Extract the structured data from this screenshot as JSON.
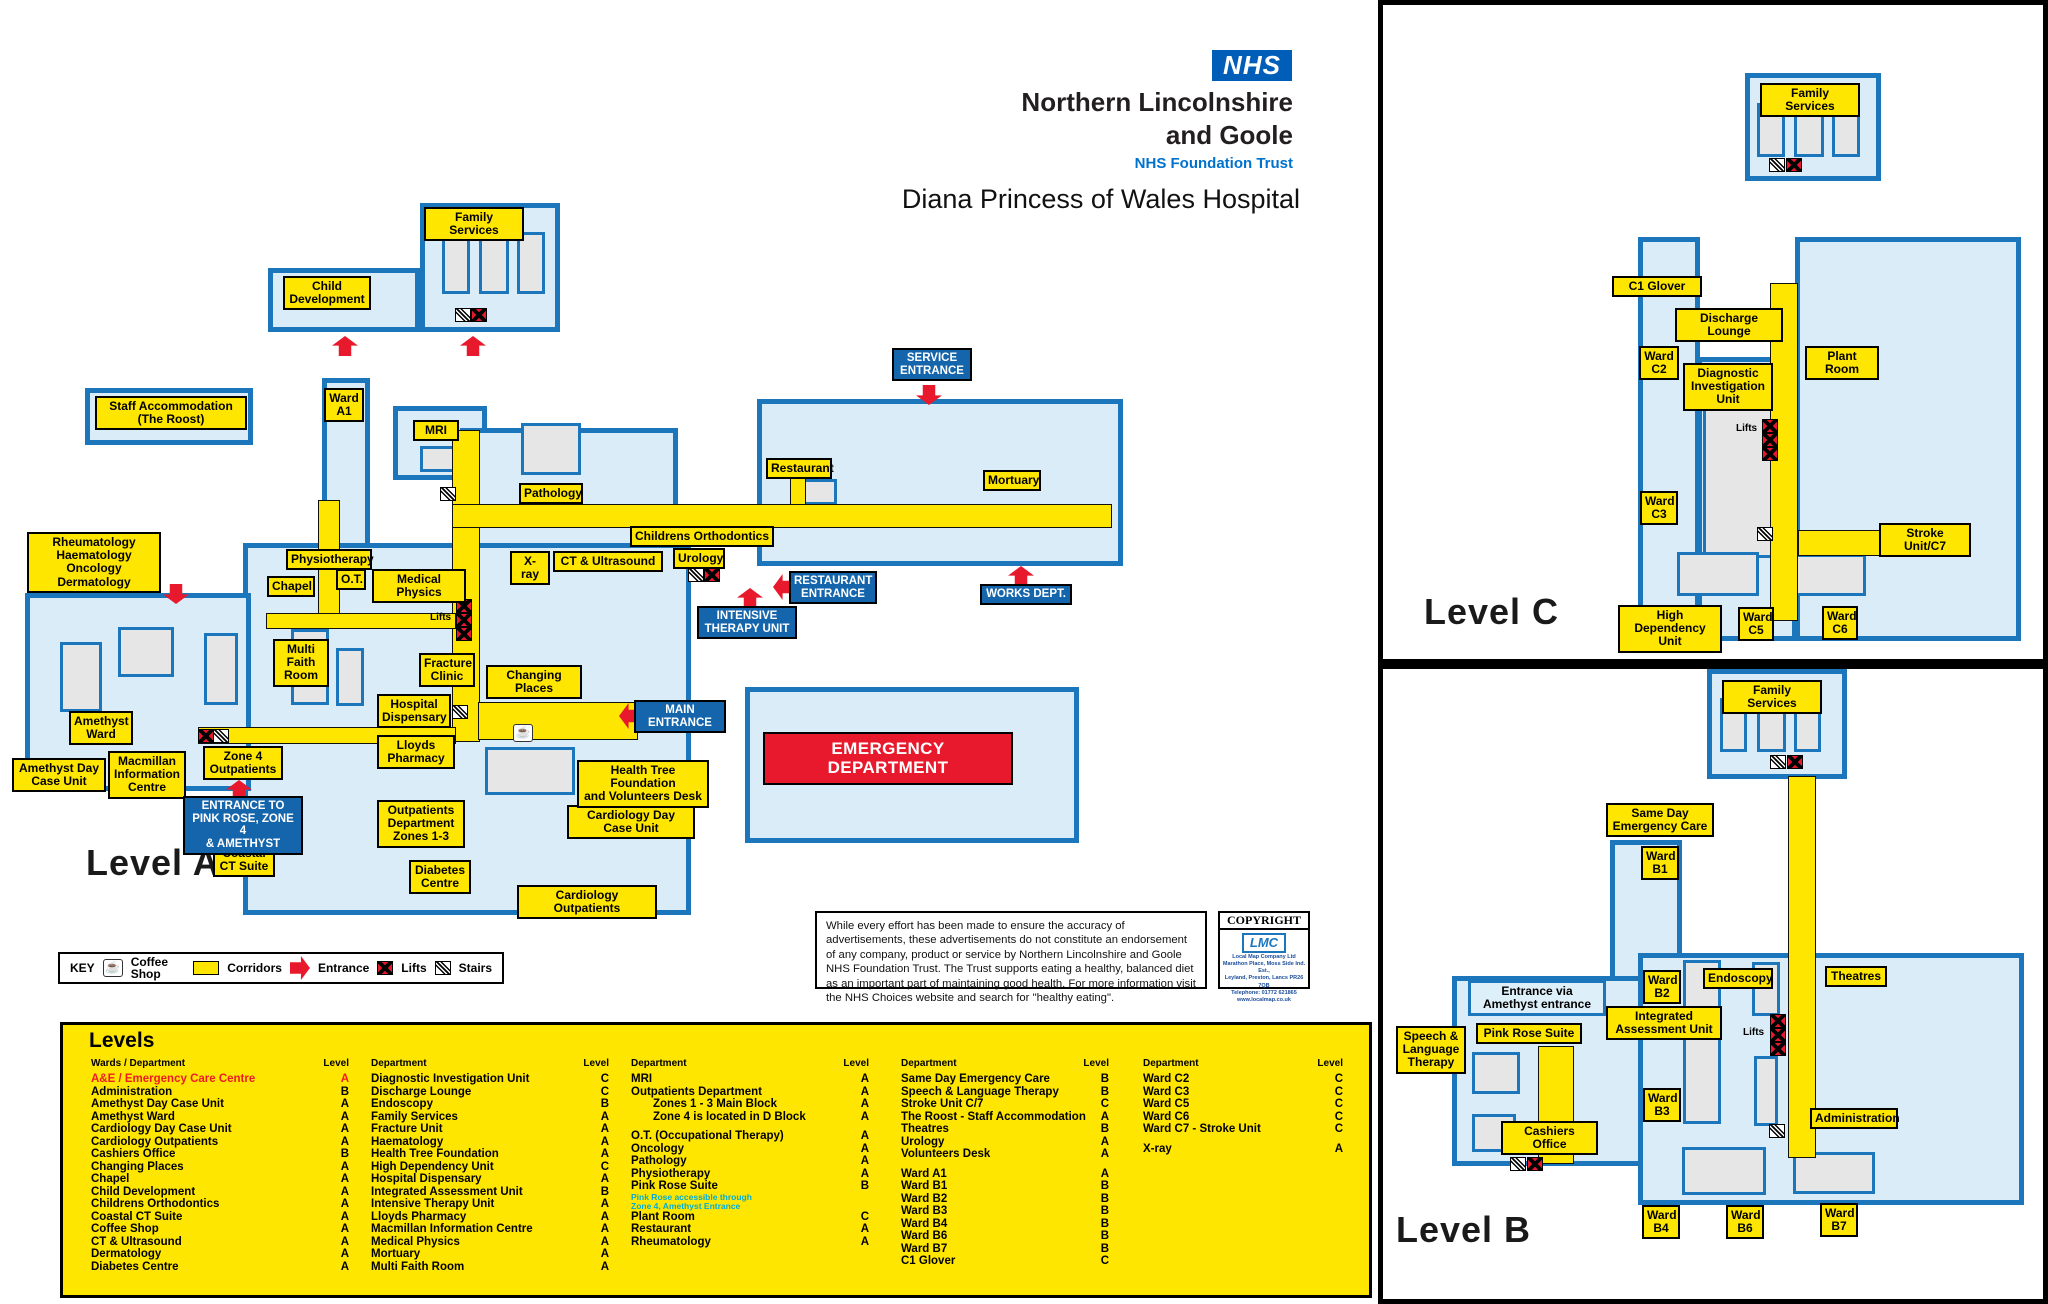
{
  "branding": {
    "nhs_logo": "NHS",
    "trust_line1": "Northern Lincolnshire",
    "trust_line2": "and Goole",
    "trust_sub": "NHS Foundation Trust",
    "hospital": "Diana Princess of Wales Hospital"
  },
  "panels": {
    "level_a_title": "Level A",
    "level_b_title": "Level B",
    "level_c_title": "Level C"
  },
  "key": {
    "title": "KEY",
    "items": [
      {
        "icon": "coffee-shop-icon",
        "label": "Coffee Shop"
      },
      {
        "icon": "corridor-swatch",
        "label": "Corridors"
      },
      {
        "icon": "entrance-arrow-icon",
        "label": "Entrance"
      },
      {
        "icon": "lift-icon",
        "label": "Lifts"
      },
      {
        "icon": "stairs-icon",
        "label": "Stairs"
      }
    ]
  },
  "disclaimer": {
    "text": "While every effort has been made to ensure the accuracy of advertisements, these advertisements do not constitute an endorsement of any company, product or service by Northern Lincolnshire and Goole NHS Foundation Trust. The Trust supports eating a healthy, balanced diet as an important part of maintaining good health. For more information visit the NHS Choices website and search for \"healthy eating\"."
  },
  "copyright": {
    "title": "COPYRIGHT",
    "logo": "LMC",
    "company": "Local Map Company Ltd",
    "address1": "Marathon Place, Moss Side Ind. Est.,",
    "address2": "Leyland, Preston, Lancs PR26 7QB",
    "phone": "Telephone: 01772 621865",
    "website": "www.localmap.co.uk"
  },
  "directory": {
    "title": "Levels",
    "columns": [
      {
        "dept_header": "Wards / Department",
        "level_header": "Level",
        "entries": [
          {
            "d": "A&E / Emergency Care Centre",
            "l": "A",
            "s": "red"
          },
          {
            "d": "Administration",
            "l": "B"
          },
          {
            "d": "Amethyst Day Case Unit",
            "l": "A"
          },
          {
            "d": "Amethyst Ward",
            "l": "A"
          },
          {
            "d": "Cardiology Day Case Unit",
            "l": "A"
          },
          {
            "d": "Cardiology Outpatients",
            "l": "A"
          },
          {
            "d": "Cashiers Office",
            "l": "B"
          },
          {
            "d": "Changing Places",
            "l": "A"
          },
          {
            "d": "Chapel",
            "l": "A"
          },
          {
            "d": "Child Development",
            "l": "A"
          },
          {
            "d": "Childrens Orthodontics",
            "l": "A"
          },
          {
            "d": "Coastal CT Suite",
            "l": "A"
          },
          {
            "d": "Coffee Shop",
            "l": "A"
          },
          {
            "d": "CT & Ultrasound",
            "l": "A"
          },
          {
            "d": "Dermatology",
            "l": "A"
          },
          {
            "d": "Diabetes Centre",
            "l": "A"
          }
        ]
      },
      {
        "dept_header": "Department",
        "level_header": "Level",
        "entries": [
          {
            "d": "Diagnostic Investigation Unit",
            "l": "C"
          },
          {
            "d": "Discharge Lounge",
            "l": "C"
          },
          {
            "d": "Endoscopy",
            "l": "B"
          },
          {
            "d": "Family Services",
            "l": "A"
          },
          {
            "d": "Fracture Unit",
            "l": "A"
          },
          {
            "d": "Haematology",
            "l": "A"
          },
          {
            "d": "Health Tree Foundation",
            "l": "A"
          },
          {
            "d": "High Dependency Unit",
            "l": "C"
          },
          {
            "d": "Hospital Dispensary",
            "l": "A"
          },
          {
            "d": "Integrated Assessment Unit",
            "l": "B"
          },
          {
            "d": "Intensive Therapy Unit",
            "l": "A"
          },
          {
            "d": "Lloyds Pharmacy",
            "l": "A"
          },
          {
            "d": "Macmillan Information Centre",
            "l": "A"
          },
          {
            "d": "Medical Physics",
            "l": "A"
          },
          {
            "d": "Mortuary",
            "l": "A"
          },
          {
            "d": "Multi Faith Room",
            "l": "A"
          }
        ]
      },
      {
        "dept_header": "Department",
        "level_header": "Level",
        "entries": [
          {
            "d": "MRI",
            "l": "A"
          },
          {
            "d": "Outpatients Department",
            "l": "A"
          },
          {
            "d": "Zones 1 - 3 Main Block",
            "l": "A",
            "s": "indent"
          },
          {
            "d": "Zone 4 is located in D Block",
            "l": "A",
            "s": "indent"
          },
          {
            "s": "gap"
          },
          {
            "d": "O.T. (Occupational Therapy)",
            "l": "A"
          },
          {
            "d": "Oncology",
            "l": "A"
          },
          {
            "d": "Pathology",
            "l": "A"
          },
          {
            "d": "Physiotherapy",
            "l": "A"
          },
          {
            "d": "Pink Rose Suite",
            "l": "B"
          },
          {
            "d": "Pink Rose accessible through\nZone 4, Amethyst Entrance",
            "s": "note"
          },
          {
            "d": "Plant Room",
            "l": "C"
          },
          {
            "d": "Restaurant",
            "l": "A"
          },
          {
            "d": "Rheumatology",
            "l": "A"
          }
        ]
      },
      {
        "dept_header": "Department",
        "level_header": "Level",
        "entries": [
          {
            "d": "Same Day Emergency Care",
            "l": "B"
          },
          {
            "d": "Speech & Language Therapy",
            "l": "B"
          },
          {
            "d": "Stroke Unit C/7",
            "l": "C"
          },
          {
            "d": "The Roost - Staff Accommodation",
            "l": "A"
          },
          {
            "d": "Theatres",
            "l": "B"
          },
          {
            "d": "Urology",
            "l": "A"
          },
          {
            "d": "Volunteers Desk",
            "l": "A"
          },
          {
            "s": "gap"
          },
          {
            "d": "Ward A1",
            "l": "A"
          },
          {
            "d": "Ward B1",
            "l": "B"
          },
          {
            "d": "Ward B2",
            "l": "B"
          },
          {
            "d": "Ward B3",
            "l": "B"
          },
          {
            "d": "Ward B4",
            "l": "B"
          },
          {
            "d": "Ward B6",
            "l": "B"
          },
          {
            "d": "Ward B7",
            "l": "B"
          },
          {
            "d": "C1 Glover",
            "l": "C"
          }
        ]
      },
      {
        "dept_header": "Department",
        "level_header": "Level",
        "entries": [
          {
            "d": "Ward C2",
            "l": "C"
          },
          {
            "d": "Ward C3",
            "l": "C"
          },
          {
            "d": "Ward C5",
            "l": "C"
          },
          {
            "d": "Ward C6",
            "l": "C"
          },
          {
            "d": "Ward C7 - Stroke Unit",
            "l": "C"
          },
          {
            "s": "gap"
          },
          {
            "d": "X-ray",
            "l": "A"
          }
        ]
      }
    ]
  },
  "maps": {
    "level_a": {
      "labels": [
        {
          "t": "Family Services",
          "x": 424,
          "y": 207,
          "w": 100
        },
        {
          "t": "Child\nDevelopment",
          "x": 283,
          "y": 276,
          "w": 88
        },
        {
          "t": "Staff Accommodation\n(The Roost)",
          "x": 95,
          "y": 396,
          "w": 152
        },
        {
          "t": "Ward\nA1",
          "x": 324,
          "y": 388,
          "w": 40
        },
        {
          "t": "MRI",
          "x": 413,
          "y": 420,
          "w": 46
        },
        {
          "t": "Rheumatology\nHaematology\nOncology\nDermatology",
          "x": 27,
          "y": 532,
          "w": 134
        },
        {
          "t": "Physiotherapy",
          "x": 286,
          "y": 549,
          "w": 86
        },
        {
          "t": "O.T.",
          "x": 336,
          "y": 569,
          "w": 30
        },
        {
          "t": "Medical Physics",
          "x": 372,
          "y": 569,
          "w": 94
        },
        {
          "t": "Chapel",
          "x": 267,
          "y": 576,
          "w": 48
        },
        {
          "t": "Pathology",
          "x": 519,
          "y": 483,
          "w": 64
        },
        {
          "t": "Childrens Orthodontics",
          "x": 630,
          "y": 526,
          "w": 144
        },
        {
          "t": "X-ray",
          "x": 510,
          "y": 551,
          "w": 40
        },
        {
          "t": "CT & Ultrasound",
          "x": 553,
          "y": 551,
          "w": 110
        },
        {
          "t": "Urology",
          "x": 673,
          "y": 548,
          "w": 52
        },
        {
          "t": "Restaurant",
          "x": 766,
          "y": 458,
          "w": 66
        },
        {
          "t": "Mortuary",
          "x": 983,
          "y": 470,
          "w": 58
        },
        {
          "t": "Multi\nFaith\nRoom",
          "x": 273,
          "y": 639,
          "w": 56
        },
        {
          "t": "Fracture\nClinic",
          "x": 419,
          "y": 653,
          "w": 56
        },
        {
          "t": "Changing Places",
          "x": 486,
          "y": 665,
          "w": 96
        },
        {
          "t": "Hospital\nDispensary",
          "x": 377,
          "y": 694,
          "w": 74
        },
        {
          "t": "Lloyds\nPharmacy",
          "x": 377,
          "y": 735,
          "w": 78
        },
        {
          "t": "Amethyst\nWard",
          "x": 69,
          "y": 711,
          "w": 64
        },
        {
          "t": "Amethyst Day\nCase Unit",
          "x": 12,
          "y": 758,
          "w": 94
        },
        {
          "t": "Macmillan\nInformation\nCentre",
          "x": 108,
          "y": 751,
          "w": 78
        },
        {
          "t": "Zone 4\nOutpatients",
          "x": 203,
          "y": 746,
          "w": 80
        },
        {
          "t": "Coastal\nCT Suite",
          "x": 213,
          "y": 843,
          "w": 62
        },
        {
          "t": "Outpatients\nDepartment\nZones 1-3",
          "x": 377,
          "y": 800,
          "w": 88
        },
        {
          "t": "Diabetes\nCentre",
          "x": 409,
          "y": 860,
          "w": 62
        },
        {
          "t": "Cardiology Outpatients",
          "x": 517,
          "y": 885,
          "w": 140
        },
        {
          "t": "Cardiology Day\nCase Unit",
          "x": 567,
          "y": 805,
          "w": 128
        },
        {
          "t": "Health Tree Foundation\nand Volunteers Desk",
          "x": 577,
          "y": 760,
          "w": 132
        },
        {
          "t": "Lifts",
          "x": 430,
          "y": 612,
          "type": "p"
        },
        {
          "t": "SERVICE\nENTRANCE",
          "x": 892,
          "y": 348,
          "w": 80,
          "type": "b"
        },
        {
          "t": "RESTAURANT\nENTRANCE",
          "x": 789,
          "y": 571,
          "w": 88,
          "type": "b"
        },
        {
          "t": "WORKS DEPT.",
          "x": 980,
          "y": 584,
          "w": 92,
          "type": "b"
        },
        {
          "t": "INTENSIVE\nTHERAPY UNIT",
          "x": 697,
          "y": 606,
          "w": 100,
          "type": "b"
        },
        {
          "t": "MAIN\nENTRANCE",
          "x": 634,
          "y": 700,
          "w": 92,
          "type": "b"
        },
        {
          "t": "ENTRANCE TO\nPINK ROSE, ZONE 4\n& AMETHYST",
          "x": 183,
          "y": 796,
          "w": 120,
          "type": "b"
        },
        {
          "t": "EMERGENCY DEPARTMENT",
          "x": 763,
          "y": 732,
          "w": 250,
          "type": "r"
        }
      ]
    },
    "level_c": {
      "labels": [
        {
          "t": "Family Services",
          "x": 1760,
          "y": 83,
          "w": 100
        },
        {
          "t": "C1 Glover",
          "x": 1612,
          "y": 276,
          "w": 90
        },
        {
          "t": "Discharge Lounge",
          "x": 1675,
          "y": 308,
          "w": 108
        },
        {
          "t": "Ward\nC2",
          "x": 1639,
          "y": 346,
          "w": 40
        },
        {
          "t": "Diagnostic\nInvestigation\nUnit",
          "x": 1683,
          "y": 363,
          "w": 90
        },
        {
          "t": "Plant Room",
          "x": 1805,
          "y": 346,
          "w": 74
        },
        {
          "t": "Lifts",
          "x": 1736,
          "y": 423,
          "type": "p"
        },
        {
          "t": "Ward\nC3",
          "x": 1640,
          "y": 491,
          "w": 38
        },
        {
          "t": "Stroke Unit/C7",
          "x": 1879,
          "y": 523,
          "w": 92
        },
        {
          "t": "High Dependency\nUnit",
          "x": 1618,
          "y": 605,
          "w": 104
        },
        {
          "t": "Ward\nC5",
          "x": 1738,
          "y": 607,
          "w": 36
        },
        {
          "t": "Ward\nC6",
          "x": 1822,
          "y": 606,
          "w": 36
        }
      ]
    },
    "level_b": {
      "labels": [
        {
          "t": "Family Services",
          "x": 1722,
          "y": 680,
          "w": 100
        },
        {
          "t": "Same Day\nEmergency Care",
          "x": 1606,
          "y": 803,
          "w": 108
        },
        {
          "t": "Ward\nB1",
          "x": 1641,
          "y": 846,
          "w": 38
        },
        {
          "t": "Entrance via\nAmethyst entrance",
          "x": 1468,
          "y": 980,
          "w": 138,
          "type": "lt"
        },
        {
          "t": "Pink Rose Suite",
          "x": 1476,
          "y": 1023,
          "w": 106
        },
        {
          "t": "Speech &\nLanguage\nTherapy",
          "x": 1396,
          "y": 1026,
          "w": 70
        },
        {
          "t": "Cashiers Office",
          "x": 1501,
          "y": 1121,
          "w": 97
        },
        {
          "t": "Ward\nB2",
          "x": 1643,
          "y": 970,
          "w": 38
        },
        {
          "t": "Integrated\nAssessment Unit",
          "x": 1606,
          "y": 1006,
          "w": 116
        },
        {
          "t": "Endoscopy",
          "x": 1703,
          "y": 968,
          "w": 70
        },
        {
          "t": "Lifts",
          "x": 1743,
          "y": 1027,
          "type": "p"
        },
        {
          "t": "Theatres",
          "x": 1825,
          "y": 966,
          "w": 62
        },
        {
          "t": "Ward\nB3",
          "x": 1643,
          "y": 1088,
          "w": 38
        },
        {
          "t": "Administration",
          "x": 1810,
          "y": 1108,
          "w": 88
        },
        {
          "t": "Ward\nB4",
          "x": 1642,
          "y": 1205,
          "w": 38
        },
        {
          "t": "Ward\nB6",
          "x": 1726,
          "y": 1205,
          "w": 38
        },
        {
          "t": "Ward\nB7",
          "x": 1820,
          "y": 1203,
          "w": 38
        }
      ]
    }
  }
}
